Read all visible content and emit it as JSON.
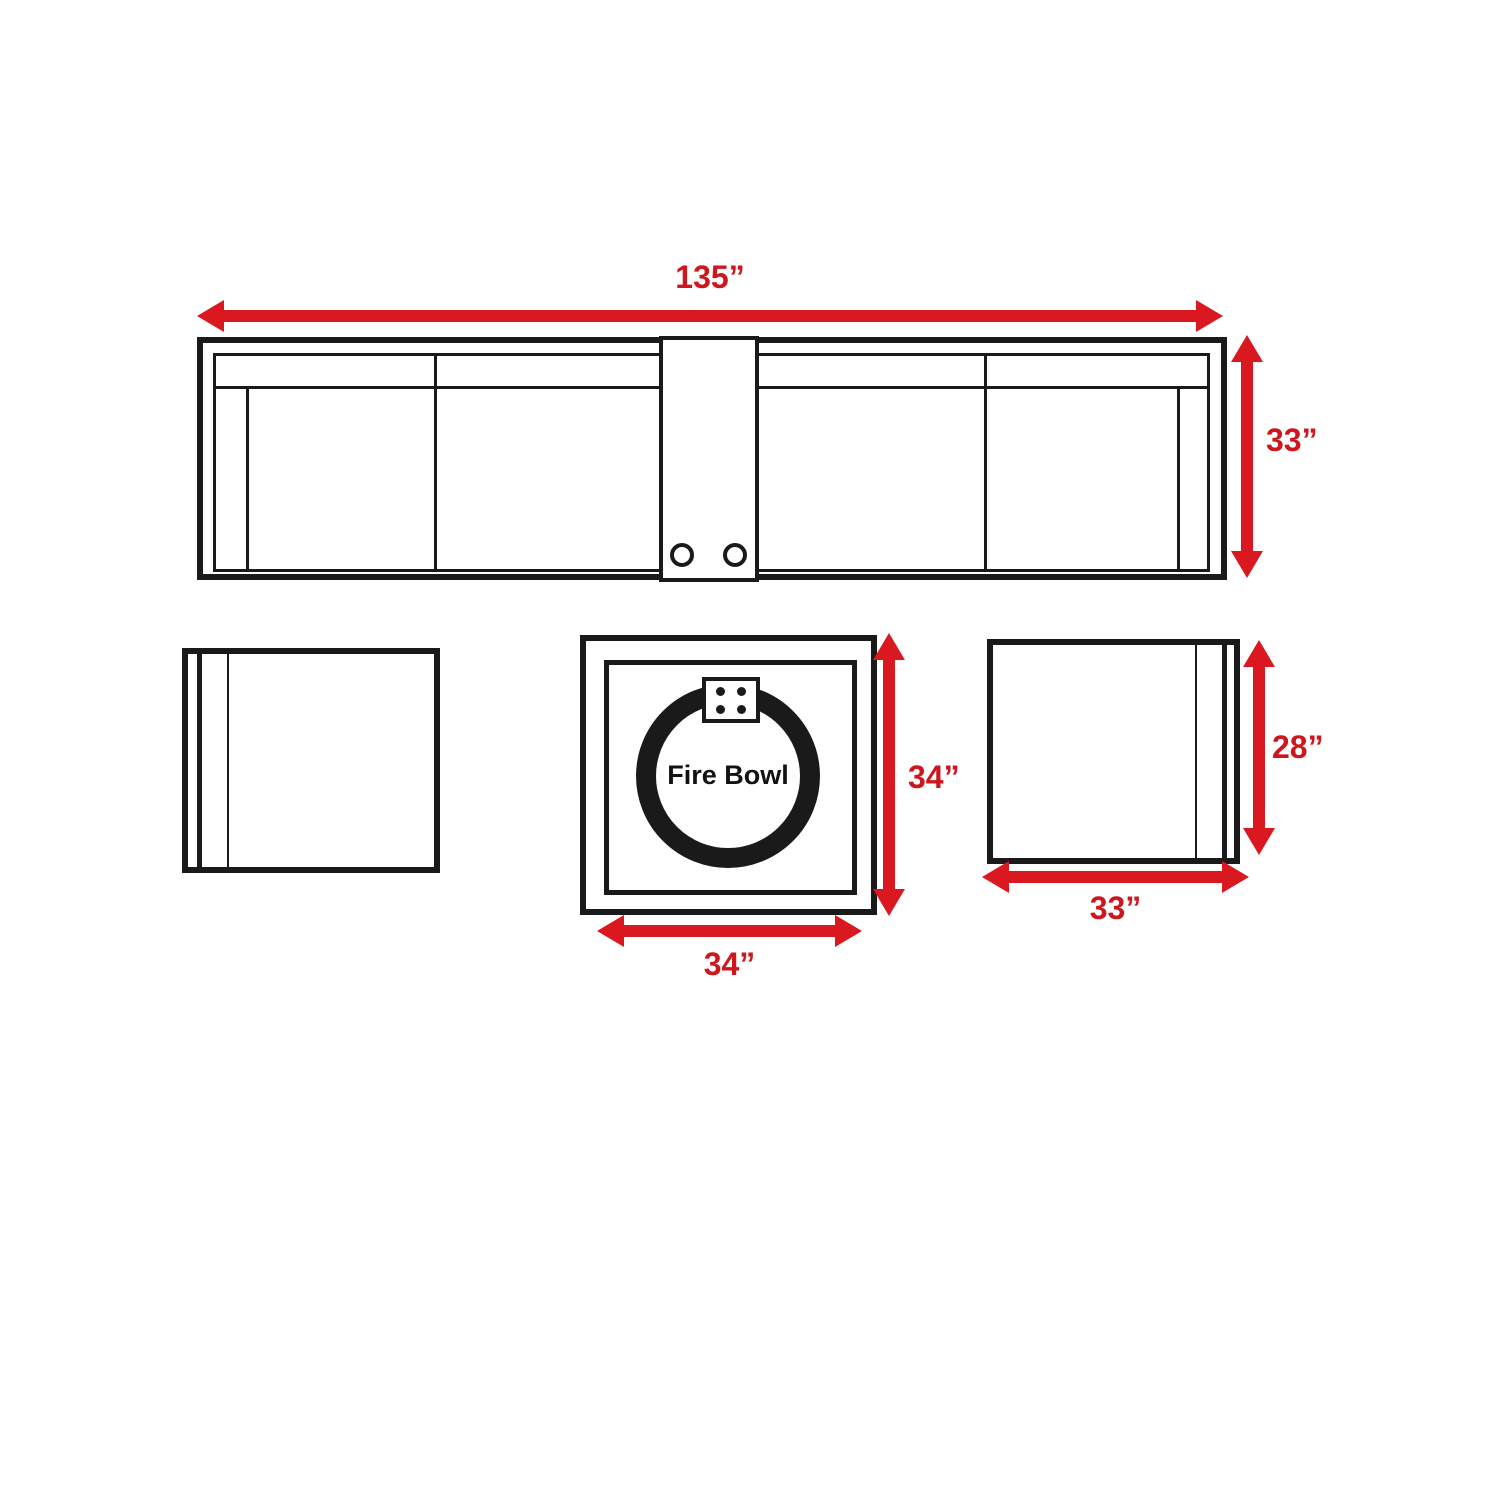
{
  "diagram": {
    "sofa": {
      "width_label": "135”",
      "height_label": "33”"
    },
    "fire_table": {
      "label": "Fire Bowl",
      "height_label": "34”",
      "width_label": "34”"
    },
    "chair": {
      "height_label": "28”",
      "width_label": "33”"
    },
    "colors": {
      "arrow_red": "#d9191f",
      "label_red": "#ce161d",
      "line_black": "#1a1a1a"
    }
  }
}
